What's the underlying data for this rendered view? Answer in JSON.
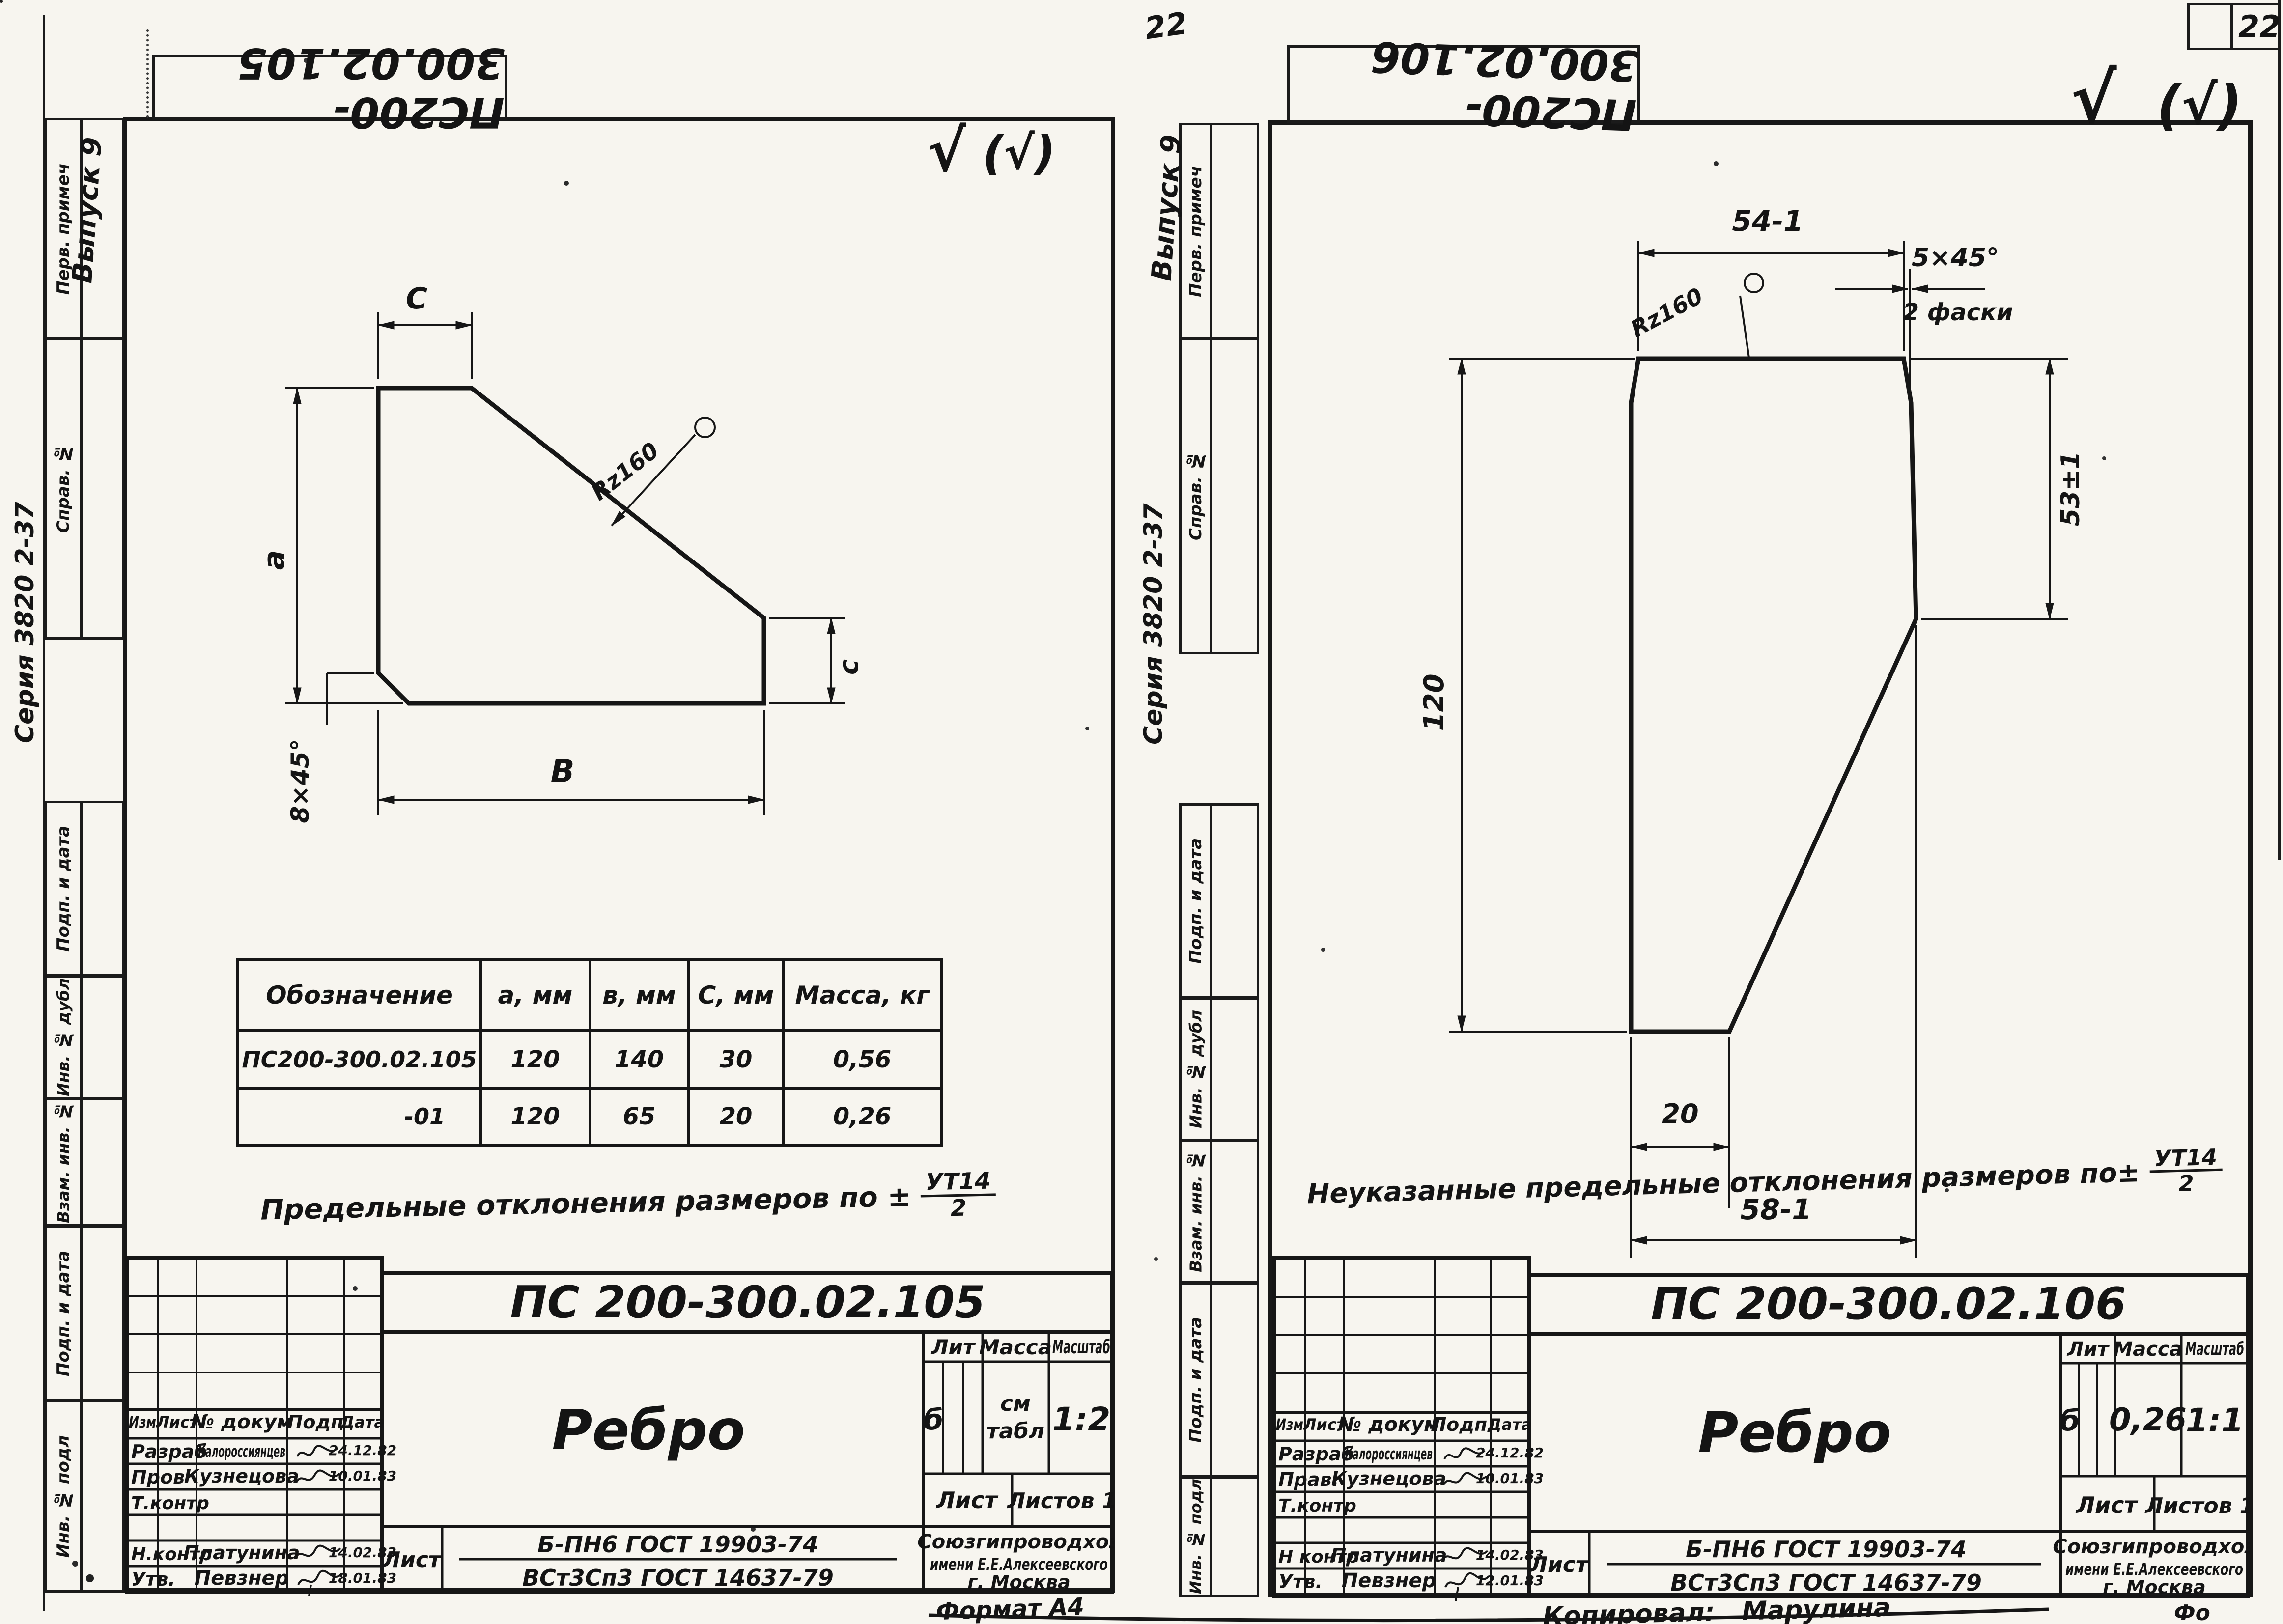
{
  "page": {
    "corner_number": "22",
    "handwritten_number": "22",
    "format_partial": "Фо"
  },
  "left": {
    "stamp": "ПС200-300.02.105",
    "roughness_main": "√",
    "roughness_alt": "(√)",
    "margin": {
      "series": "Серия 3820 2-37",
      "issue": "Выпуск 9",
      "box_perv": "Перв. примеч",
      "box_sprav": "Справ. №",
      "box_podp1": "Подп. и дата",
      "box_dubl": "Инв. № дубл",
      "box_vzam": "Взам. инв. №",
      "box_podp2": "Подп. и дата",
      "box_podl": "Инв. № подл"
    },
    "dims": {
      "c_top": "C",
      "a_left": "a",
      "chamfer": "8×45°",
      "b_bottom": "В",
      "c_right": "с",
      "rz": "Rz160"
    },
    "table": {
      "h_designation": "Обозначение",
      "h_a": "а, мм",
      "h_b": "в, мм",
      "h_c": "С, мм",
      "h_mass": "Масса, кг",
      "rows": [
        [
          "ПС200-300.02.105",
          "120",
          "140",
          "30",
          "0,56"
        ],
        [
          "-01",
          "120",
          "65",
          "20",
          "0,26"
        ]
      ]
    },
    "note": {
      "text": "Предельные отклонения размеров по ±",
      "frac_num": "УТ14",
      "frac_den": "2"
    },
    "tb": {
      "doc": "ПС 200-300.02.105",
      "name": "Ребро",
      "h_izm": "Изм",
      "h_list": "Лист",
      "h_doc": "№ докум",
      "h_podp": "Подп",
      "h_data": "Дата",
      "r1_role": "Разраб",
      "r1_name": "Калороссиянцев",
      "r1_date": "24.12.82",
      "r2_role": "Пров",
      "r2_name": "Кузнецова",
      "r2_date": "10.01.83",
      "r3_role": "Т.контр",
      "r4_role": "Н.контр",
      "r4_name": "Платунина",
      "r4_date": "14.02.83",
      "r5_role": "Утв.",
      "r5_name": "Певзнер",
      "r5_date": "18.01.83",
      "lit_label": "Лит",
      "mass_label": "Масса",
      "scale_label": "Масштаб",
      "lit": "б",
      "mass1": "см",
      "mass2": "табл",
      "scale": "1:2",
      "sheet_label": "Лист",
      "sheets_label": "Листов 1",
      "mat_label": "Лист",
      "mat_top": "Б-ПН6 ГОСТ 19903-74",
      "mat_bottom": "ВСт3Сп3 ГОСТ 14637-79",
      "org1": "Союзгипроводхоз",
      "org2": "имени Е.Е.Алексеевского",
      "org3": "г. Москва",
      "format": "Формат А4"
    }
  },
  "right": {
    "stamp": "ПС200-300.02.106",
    "roughness_main": "√",
    "roughness_alt": "(√)",
    "margin": {
      "series": "Серия 3820 2-37",
      "issue": "Выпуск 9",
      "box_perv": "Перв. примеч",
      "box_sprav": "Справ. №",
      "box_podp1": "Подп. и дата",
      "box_dubl": "Инв. № дубл",
      "box_vzam": "Взам. инв. №",
      "box_podp2": "Подп. и дата",
      "box_podl": "Инв. № подл"
    },
    "dims": {
      "w_top": "54-1",
      "rz": "Rz160",
      "chamfer": "5×45°",
      "chamfer_note": "2 фаски",
      "h_right": "53±1",
      "h_left": "120",
      "w_small": "20",
      "w_bottom": "58-1"
    },
    "note": {
      "text": "Неуказанные предельные отклонения размеров по±",
      "frac_num": "УТ14",
      "frac_den": "2"
    },
    "tb": {
      "doc": "ПС 200-300.02.106",
      "name": "Ребро",
      "h_izm": "Изм",
      "h_list": "Лист",
      "h_doc": "№ докум",
      "h_podp": "Подп.",
      "h_data": "Дата",
      "r1_role": "Разраб",
      "r1_name": "Калороссиянцев",
      "r1_date": "24.12.82",
      "r2_role": "Прав.",
      "r2_name": "Кузнецова",
      "r2_date": "10.01.83",
      "r3_role": "Т.контр",
      "r4_role": "Н контр",
      "r4_name": "Платунина",
      "r4_date": "14.02.83",
      "r5_role": "Утв.",
      "r5_name": "Певзнер",
      "r5_date": "12.01.83",
      "lit_label": "Лит",
      "mass_label": "Масса",
      "scale_label": "Масштаб",
      "lit": "б",
      "mass": "0,26",
      "scale": "1:1",
      "sheet_label": "Лист",
      "sheets_label": "Листов 1",
      "mat_label": "Лист",
      "mat_top": "Б-ПН6 ГОСТ 19903-74",
      "mat_bottom": "ВСт3Сп3 ГОСТ 14637-79",
      "org1": "Союзгипроводхоз",
      "org2": "имени Е.Е.Алексеевского",
      "org3": "г. Москва",
      "copied_label": "Копировал:",
      "copied_name": "Марулина"
    }
  }
}
